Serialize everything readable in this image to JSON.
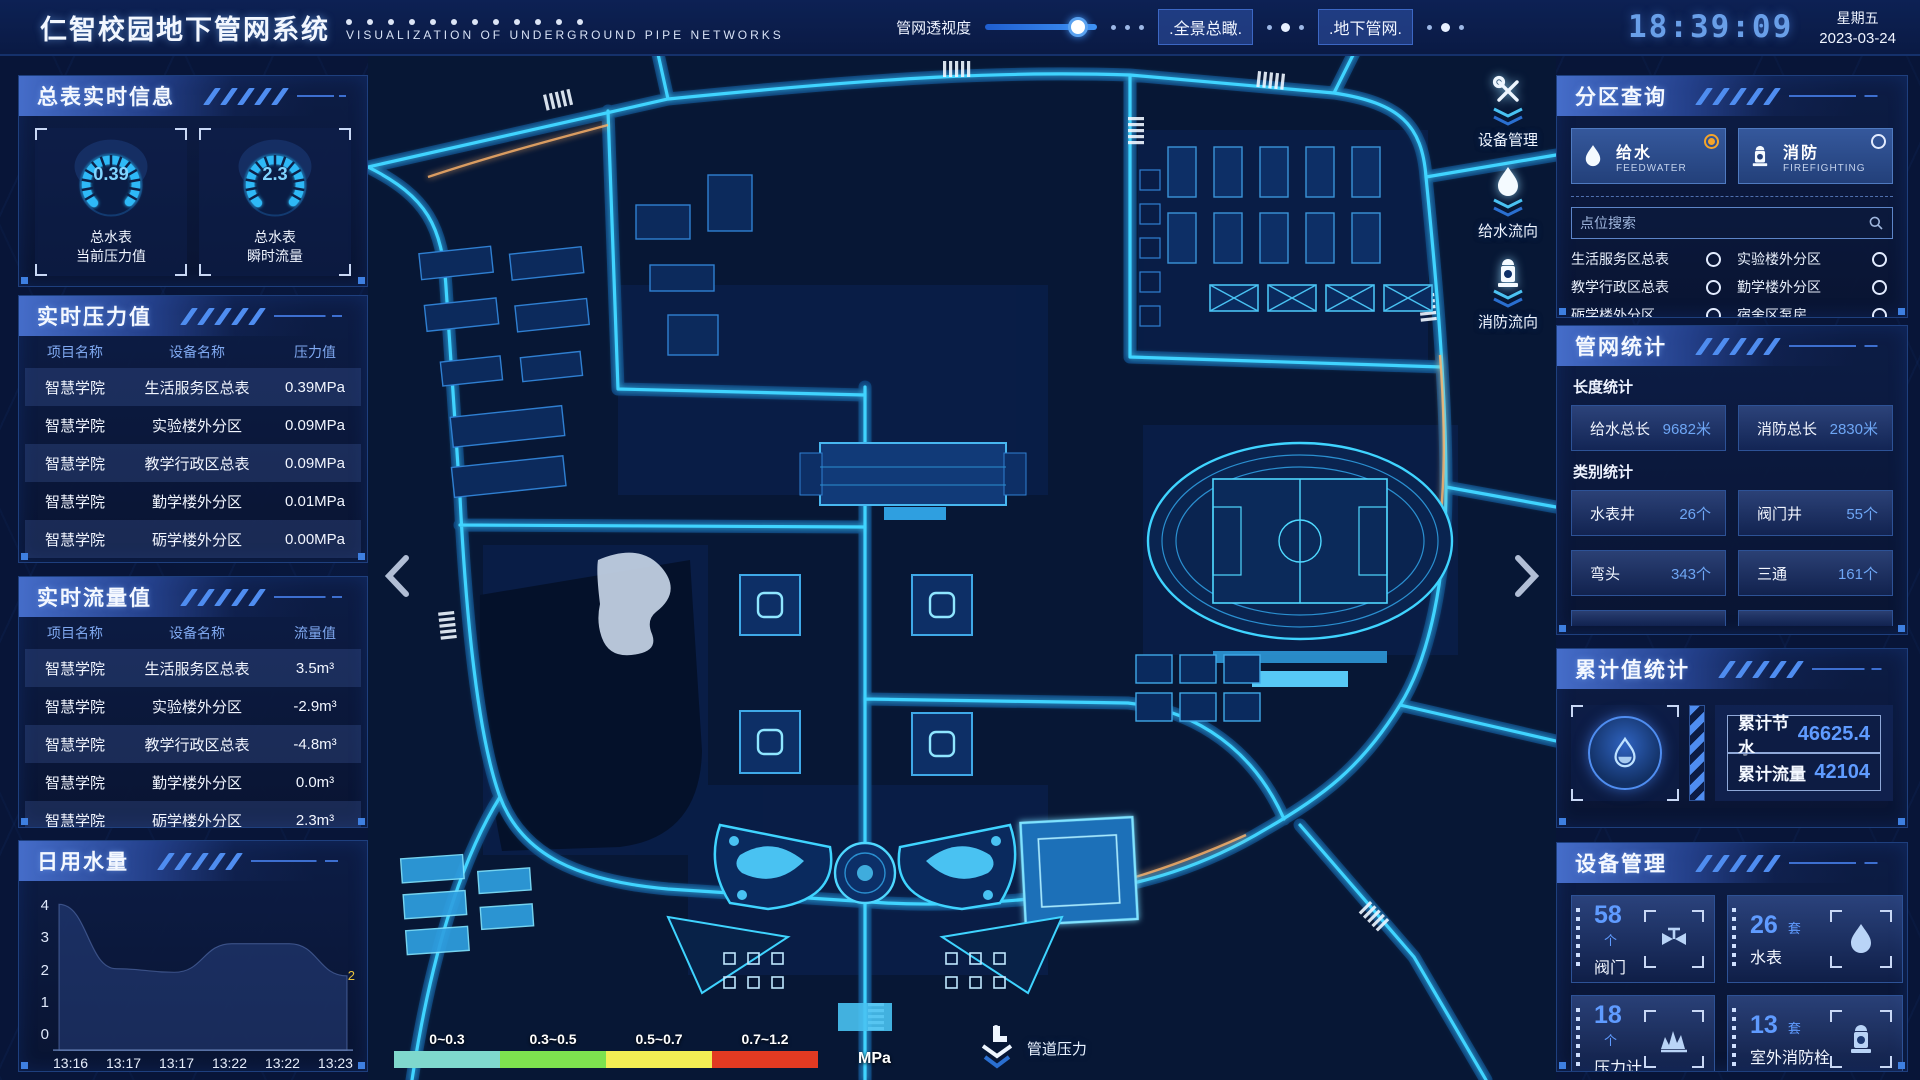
{
  "header": {
    "title": "仁智校园地下管网系统",
    "subtitle": "VISUALIZATION OF UNDERGROUND PIPE NETWORKS",
    "transparency_label": "管网透视度",
    "btn_overview": ".全景总瞰.",
    "btn_underground": ".地下管网.",
    "clock": "18:39:09",
    "weekday": "星期五",
    "date": "2023-03-24"
  },
  "sections": {
    "master": {
      "title": "总表实时信息",
      "gauges": [
        {
          "value": "0.39",
          "line1": "总水表",
          "line2": "当前压力值"
        },
        {
          "value": "2.3",
          "line1": "总水表",
          "line2": "瞬时流量"
        }
      ]
    },
    "pressure": {
      "title": "实时压力值",
      "headers": [
        "项目名称",
        "设备名称",
        "压力值"
      ],
      "rows": [
        [
          "智慧学院",
          "生活服务区总表",
          "0.39MPa"
        ],
        [
          "智慧学院",
          "实验楼外分区",
          "0.09MPa"
        ],
        [
          "智慧学院",
          "教学行政区总表",
          "0.09MPa"
        ],
        [
          "智慧学院",
          "勤学楼外分区",
          "0.01MPa"
        ],
        [
          "智慧学院",
          "砺学楼外分区",
          "0.00MPa"
        ]
      ]
    },
    "flow": {
      "title": "实时流量值",
      "headers": [
        "项目名称",
        "设备名称",
        "流量值"
      ],
      "rows": [
        [
          "智慧学院",
          "生活服务区总表",
          "3.5m³"
        ],
        [
          "智慧学院",
          "实验楼外分区",
          "-2.9m³"
        ],
        [
          "智慧学院",
          "教学行政区总表",
          "-4.8m³"
        ],
        [
          "智慧学院",
          "勤学楼外分区",
          "0.0m³"
        ],
        [
          "智慧学院",
          "砺学楼外分区",
          "2.3m³"
        ]
      ]
    },
    "usage": {
      "title": "日用水量"
    },
    "zone": {
      "title": "分区查询",
      "feedwater": {
        "label": "给水",
        "en": "FEEDWATER",
        "icon": "water-drop-icon",
        "selected": true
      },
      "firefighting": {
        "label": "消防",
        "en": "FIREFIGHTING",
        "icon": "hydrant-icon",
        "selected": false
      },
      "search_placeholder": "点位搜索",
      "items": [
        {
          "label": "生活服务区总表"
        },
        {
          "label": "实验楼外分区"
        },
        {
          "label": "教学行政区总表"
        },
        {
          "label": "勤学楼外分区"
        },
        {
          "label": "砺学楼外分区"
        },
        {
          "label": "宿舍区泵房"
        }
      ]
    },
    "pipe_stats": {
      "title": "管网统计",
      "length_subtitle": "长度统计",
      "length_cards": [
        {
          "label": "给水总长",
          "value": "9682米"
        },
        {
          "label": "消防总长",
          "value": "2830米"
        }
      ],
      "category_subtitle": "类别统计",
      "category_cards": [
        {
          "label": "水表井",
          "value": "26个"
        },
        {
          "label": "阀门井",
          "value": "55个"
        },
        {
          "label": "弯头",
          "value": "343个"
        },
        {
          "label": "三通",
          "value": "161个"
        }
      ]
    },
    "cumulative": {
      "title": "累计值统计",
      "icon": "water-drop-icon",
      "rows": [
        {
          "label": "累计节水",
          "value": "46625.4"
        },
        {
          "label": "累计流量",
          "value": "42104"
        }
      ]
    },
    "devices": {
      "title": "设备管理",
      "cards": [
        {
          "count": "58",
          "unit": "个",
          "name": "阀门",
          "icon": "valve-icon"
        },
        {
          "count": "26",
          "unit": "套",
          "name": "水表",
          "icon": "water-meter-icon"
        },
        {
          "count": "18",
          "unit": "个",
          "name": "压力计",
          "icon": "pressure-gauge-icon"
        },
        {
          "count": "13",
          "unit": "套",
          "name": "室外消防栓",
          "icon": "hydrant-icon"
        }
      ]
    }
  },
  "map": {
    "tools": [
      {
        "label": "设备管理",
        "icon": "tools-icon"
      },
      {
        "label": "给水流向",
        "icon": "water-drop-icon"
      },
      {
        "label": "消防流向",
        "icon": "hydrant-icon"
      }
    ],
    "legend": {
      "items": [
        {
          "range": "0~0.3",
          "color": "#7fd8cd"
        },
        {
          "range": "0.3~0.5",
          "color": "#7de24f"
        },
        {
          "range": "0.5~0.7",
          "color": "#f3ee54"
        },
        {
          "range": "0.7~1.2",
          "color": "#e23a22"
        }
      ],
      "unit": "MPa",
      "label": "管道压力"
    }
  },
  "chart_data": {
    "type": "area",
    "title": "日用水量",
    "x": [
      "13:16",
      "13:17",
      "13:17",
      "13:22",
      "13:22",
      "13:23"
    ],
    "values": [
      4,
      2.2,
      2.1,
      2.9,
      2.9,
      2
    ],
    "ylim": [
      0,
      4
    ],
    "yticks": [
      0,
      1,
      2,
      3,
      4
    ],
    "end_label": "2",
    "grid": false,
    "legend_position": "none"
  }
}
